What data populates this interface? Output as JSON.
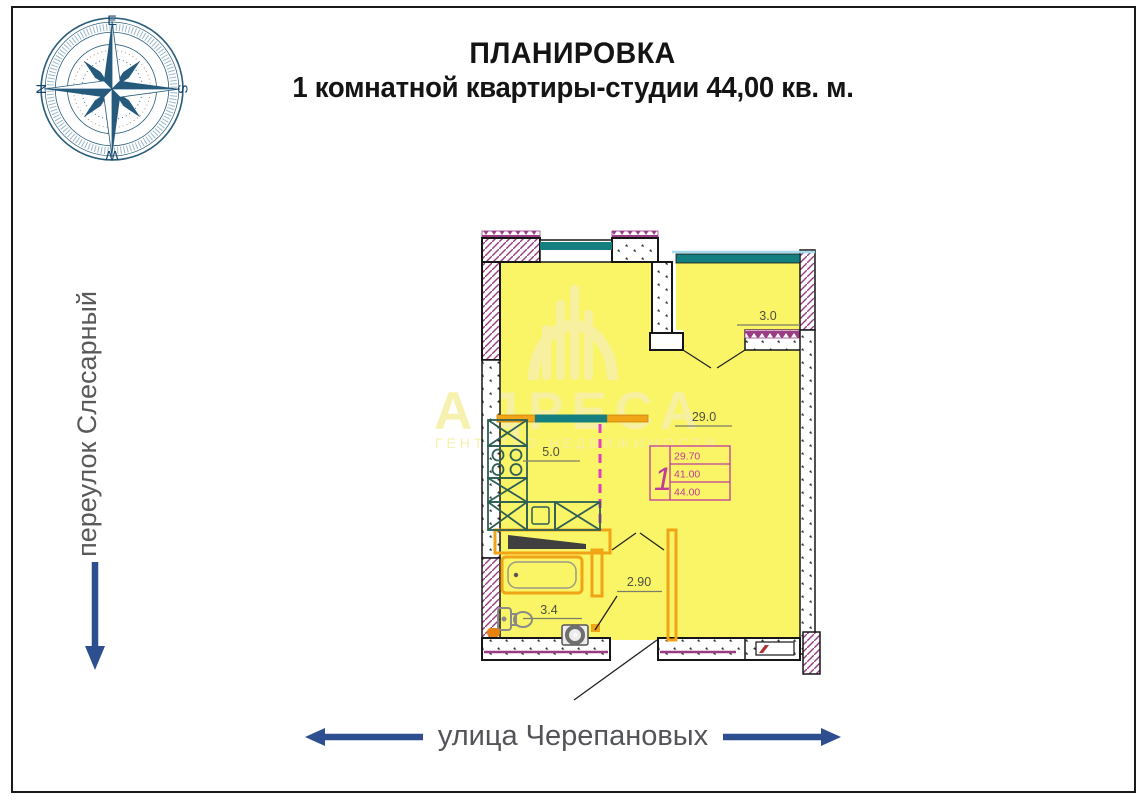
{
  "header": {
    "title_line1": "ПЛАНИРОВКА",
    "title_line2": "1 комнатной квартиры-студии 44,00 кв. м."
  },
  "compass": {
    "east": "E",
    "south": "S",
    "west": "W",
    "north": "N"
  },
  "streets": {
    "left_street": "переулок Слесарный",
    "bottom_street": "улица Черепановых"
  },
  "watermark": {
    "brand": "АДРЕСА",
    "tagline": "АГЕНТСТВО НЕДВИЖИМОСТИ"
  },
  "plan": {
    "dimensions": {
      "balcony": "3.0",
      "room": "29.0",
      "kitchen": "5.0",
      "hallway": "2.90",
      "bathroom": "3.4"
    },
    "stamp": {
      "rooms": "1",
      "living_area": "29.70",
      "total_area": "41.00",
      "total_with_balcony": "44.00"
    },
    "colors": {
      "room_fill": "#f9f566",
      "wall_accent": "#9a3d85",
      "window": "#157e7e",
      "partition": "#f0a416",
      "dashed_line": "#e23cc0",
      "stamp_accent": "#c13a9e",
      "arrow": "#2d4f8f",
      "street_text": "#58595b",
      "watermark_tint": "#f7f0a8"
    }
  }
}
